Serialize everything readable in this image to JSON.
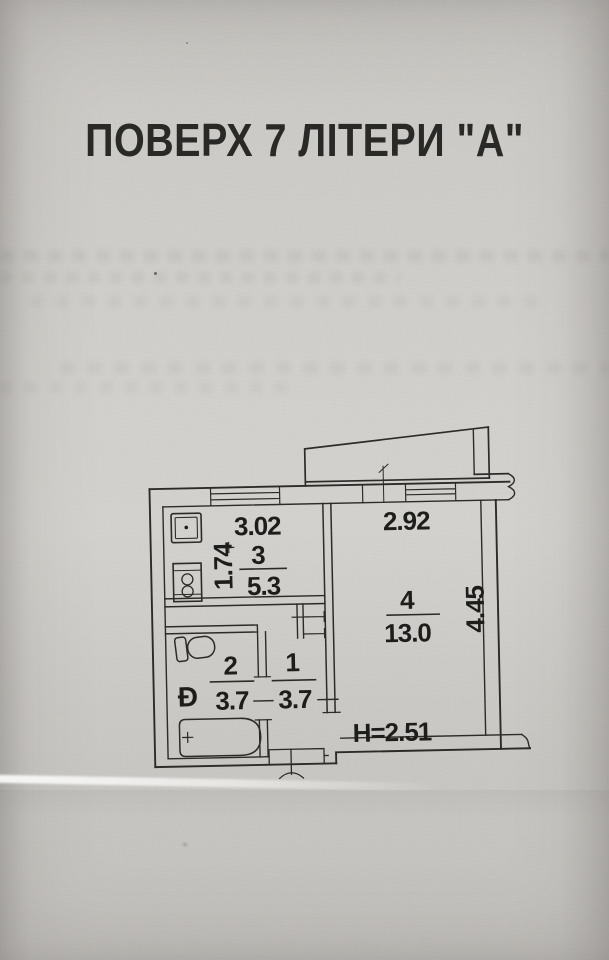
{
  "document": {
    "title": "ПОВЕРХ 7 ЛІТЕРИ \"А\""
  },
  "floor_plan": {
    "rooms": [
      {
        "number": "1",
        "area": "3.7"
      },
      {
        "number": "2",
        "area": "3.7"
      },
      {
        "number": "3",
        "area": "5.3"
      },
      {
        "number": "4",
        "area": "13.0"
      }
    ],
    "dimensions": {
      "kitchen_width": "3.02",
      "kitchen_depth": "1.74",
      "room4_width": "2.92",
      "room4_depth": "4.45",
      "ceiling_height": "H=2.51"
    },
    "fixtures": {
      "washbasin_symbol": "Ð"
    }
  }
}
